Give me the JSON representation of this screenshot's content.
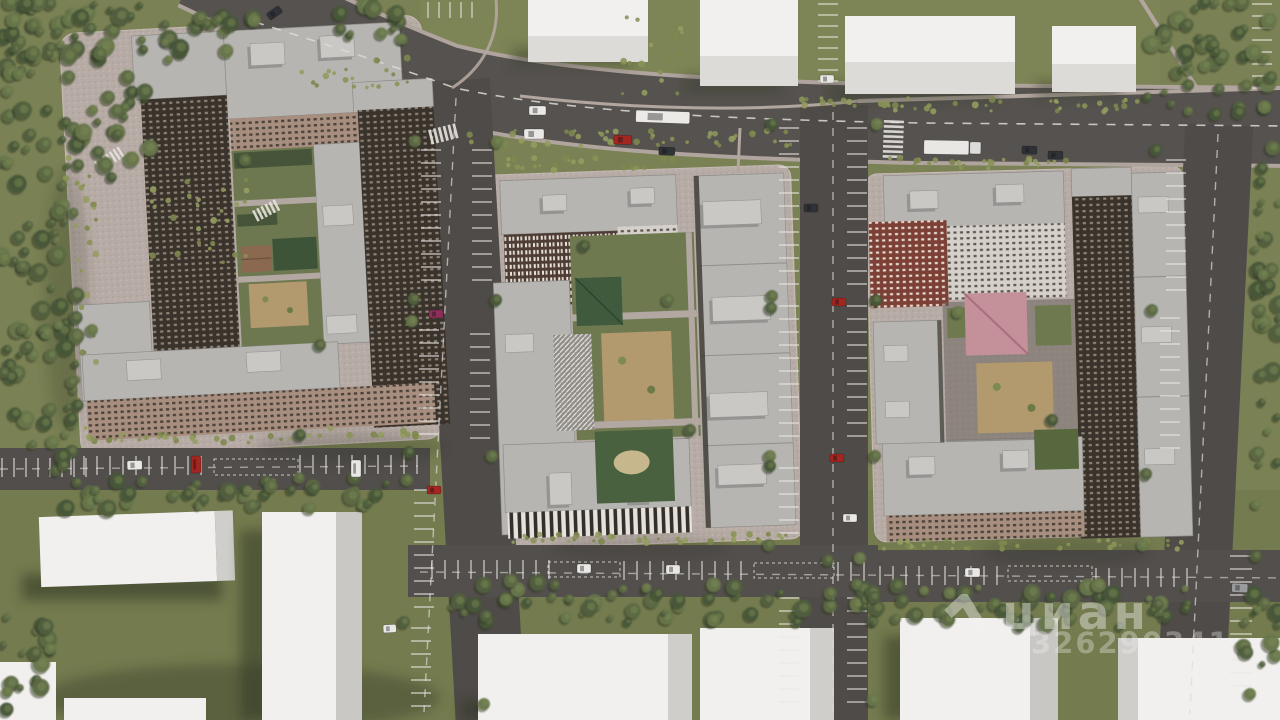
{
  "watermark": {
    "brand": "циан",
    "id_label": "ID 326290341",
    "logo_icon": "cian-chevron-logo",
    "color": "#F4F4F2"
  },
  "palette": {
    "lawn": "#7a8154",
    "lawn_dark": "#747b4f",
    "lawn_light": "#7f8757",
    "road": "#514d4a",
    "road_dark": "#4f4b48",
    "pad": "#b7aba5",
    "pad_rim": "#c6bab4",
    "roof": "#b6b5b2",
    "roof_edge": "#8d8c89",
    "roof_box": "#c9c8c5",
    "facade_dark": "#3a332c",
    "facade_brick": "#a78e7e",
    "facade_red": "#7c4036",
    "facade_light": "#d5d0c9",
    "white_building": "#f1f0ee",
    "white_building_side": "#cfcecb",
    "playground_sand": "#b29a6e",
    "sport_green": "#49613f",
    "marking": "#eae8e4"
  },
  "scene": {
    "description": "aerial 3D render of three residential quarters with courtyards, roads, parking and context buildings",
    "tree_colors": [
      "#5c6a45",
      "#51603f",
      "#68774b",
      "#475638"
    ],
    "bush_colors": [
      "#8a9356",
      "#7d874e",
      "#939c5f"
    ],
    "tree_regions": [
      {
        "x": 0,
        "y": 0,
        "w": 78,
        "h": 475,
        "n": 100
      },
      {
        "x": 0,
        "y": 0,
        "w": 255,
        "h": 60,
        "n": 52
      },
      {
        "x": 62,
        "y": 62,
        "w": 90,
        "h": 120,
        "n": 26
      },
      {
        "x": 330,
        "y": 0,
        "w": 80,
        "h": 40,
        "n": 14
      },
      {
        "x": 1142,
        "y": 0,
        "w": 138,
        "h": 116,
        "n": 46
      },
      {
        "x": 1252,
        "y": 128,
        "w": 28,
        "h": 185,
        "n": 16
      },
      {
        "x": 1256,
        "y": 300,
        "w": 24,
        "h": 205,
        "n": 14
      },
      {
        "x": 55,
        "y": 477,
        "w": 345,
        "h": 32,
        "n": 42
      },
      {
        "x": 424,
        "y": 580,
        "w": 452,
        "h": 42,
        "n": 54
      },
      {
        "x": 868,
        "y": 585,
        "w": 330,
        "h": 44,
        "n": 42
      },
      {
        "x": 0,
        "y": 598,
        "w": 58,
        "h": 122,
        "n": 18
      },
      {
        "x": 1238,
        "y": 582,
        "w": 42,
        "h": 84,
        "n": 12
      }
    ],
    "street_trees": [
      [
        415,
        141
      ],
      [
        414,
        299
      ],
      [
        412,
        321
      ],
      [
        409,
        452
      ],
      [
        407,
        480
      ],
      [
        404,
        622
      ],
      [
        497,
        142
      ],
      [
        496,
        300
      ],
      [
        492,
        456
      ],
      [
        486,
        616
      ],
      [
        484,
        704
      ],
      [
        772,
        124
      ],
      [
        772,
        296
      ],
      [
        771,
        308
      ],
      [
        770,
        456
      ],
      [
        770,
        466
      ],
      [
        769,
        545
      ],
      [
        768,
        600
      ],
      [
        877,
        124
      ],
      [
        876,
        300
      ],
      [
        875,
        456
      ],
      [
        874,
        597
      ],
      [
        873,
        700
      ],
      [
        1156,
        150
      ],
      [
        1152,
        310
      ],
      [
        1146,
        474
      ],
      [
        1143,
        545
      ],
      [
        1262,
        168
      ],
      [
        1260,
        310
      ],
      [
        1256,
        556
      ],
      [
        1250,
        694
      ],
      [
        1205,
        2
      ],
      [
        1230,
        4
      ],
      [
        828,
        560
      ],
      [
        860,
        558
      ],
      [
        584,
        246
      ],
      [
        668,
        300
      ],
      [
        690,
        430
      ],
      [
        958,
        312
      ],
      [
        1052,
        420
      ],
      [
        245,
        160
      ],
      [
        320,
        345
      ],
      [
        92,
        330
      ],
      [
        300,
        435
      ]
    ],
    "bush_strips": [
      {
        "x": 452,
        "y": 130,
        "w": 340,
        "h": 16,
        "n": 46
      },
      {
        "x": 880,
        "y": 98,
        "w": 260,
        "h": 14,
        "n": 34
      },
      {
        "x": 300,
        "y": 58,
        "w": 110,
        "h": 34,
        "n": 20
      },
      {
        "x": 150,
        "y": 178,
        "w": 100,
        "h": 90,
        "n": 26
      },
      {
        "x": 62,
        "y": 150,
        "w": 34,
        "h": 300,
        "n": 30
      },
      {
        "x": 500,
        "y": 534,
        "w": 186,
        "h": 9,
        "n": 24
      },
      {
        "x": 700,
        "y": 534,
        "w": 92,
        "h": 9,
        "n": 12
      },
      {
        "x": 878,
        "y": 540,
        "w": 196,
        "h": 9,
        "n": 24
      },
      {
        "x": 1086,
        "y": 540,
        "w": 96,
        "h": 9,
        "n": 12
      },
      {
        "x": 84,
        "y": 434,
        "w": 240,
        "h": 9,
        "n": 28
      },
      {
        "x": 330,
        "y": 428,
        "w": 96,
        "h": 9,
        "n": 12
      },
      {
        "x": 508,
        "y": 158,
        "w": 170,
        "h": 12,
        "n": 22
      },
      {
        "x": 890,
        "y": 158,
        "w": 200,
        "h": 12,
        "n": 24
      },
      {
        "x": 618,
        "y": 14,
        "w": 70,
        "h": 80,
        "n": 16
      },
      {
        "x": 800,
        "y": 96,
        "w": 60,
        "h": 12,
        "n": 10
      }
    ],
    "parking_rows": [
      {
        "x": 421,
        "y": 150,
        "n": 11,
        "step": 13,
        "len": 20,
        "o": "h"
      },
      {
        "x": 419,
        "y": 330,
        "n": 9,
        "step": 13,
        "len": 20,
        "o": "h"
      },
      {
        "x": 414,
        "y": 490,
        "n": 10,
        "step": 13,
        "len": 20,
        "o": "h"
      },
      {
        "x": 411,
        "y": 628,
        "n": 7,
        "step": 13,
        "len": 20,
        "o": "h"
      },
      {
        "x": 472,
        "y": 150,
        "n": 11,
        "step": 13,
        "len": 20,
        "o": "h"
      },
      {
        "x": 470,
        "y": 334,
        "n": 9,
        "step": 13,
        "len": 20,
        "o": "h"
      },
      {
        "x": 779,
        "y": 128,
        "n": 13,
        "step": 13,
        "len": 20,
        "o": "h"
      },
      {
        "x": 779,
        "y": 306,
        "n": 11,
        "step": 13,
        "len": 20,
        "o": "h"
      },
      {
        "x": 779,
        "y": 468,
        "n": 6,
        "step": 13,
        "len": 20,
        "o": "h"
      },
      {
        "x": 779,
        "y": 598,
        "n": 9,
        "step": 13,
        "len": 20,
        "o": "h"
      },
      {
        "x": 847,
        "y": 128,
        "n": 13,
        "step": 13,
        "len": 20,
        "o": "h"
      },
      {
        "x": 847,
        "y": 306,
        "n": 11,
        "step": 13,
        "len": 20,
        "o": "h"
      },
      {
        "x": 847,
        "y": 598,
        "n": 9,
        "step": 13,
        "len": 20,
        "o": "h"
      },
      {
        "x": 1166,
        "y": 160,
        "n": 11,
        "step": 13,
        "len": 20,
        "o": "h"
      },
      {
        "x": 1160,
        "y": 318,
        "n": 11,
        "step": 13,
        "len": 20,
        "o": "h"
      },
      {
        "x": 1252,
        "y": 4,
        "n": 8,
        "step": 12,
        "len": 20,
        "o": "h"
      },
      {
        "x": 1230,
        "y": 556,
        "n": 11,
        "step": 13,
        "len": 22,
        "o": "h"
      },
      {
        "x": 58,
        "y": 456,
        "n": 12,
        "step": 13,
        "len": 19,
        "o": "v"
      },
      {
        "x": 300,
        "y": 455,
        "n": 10,
        "step": 13,
        "len": 19,
        "o": "v"
      },
      {
        "x": 2,
        "y": 458,
        "n": 8,
        "step": 12,
        "len": 19,
        "o": "v"
      },
      {
        "x": 432,
        "y": 560,
        "n": 10,
        "step": 13,
        "len": 19,
        "o": "v"
      },
      {
        "x": 624,
        "y": 561,
        "n": 10,
        "step": 13,
        "len": 19,
        "o": "v"
      },
      {
        "x": 838,
        "y": 562,
        "n": 3,
        "step": 13,
        "len": 19,
        "o": "v"
      },
      {
        "x": 880,
        "y": 566,
        "n": 10,
        "step": 13,
        "len": 19,
        "o": "v"
      },
      {
        "x": 1096,
        "y": 568,
        "n": 8,
        "step": 13,
        "len": 19,
        "o": "v"
      },
      {
        "x": 818,
        "y": 4,
        "n": 8,
        "step": 11,
        "len": 20,
        "o": "h"
      },
      {
        "x": 428,
        "y": 2,
        "n": 5,
        "step": 11,
        "len": 16,
        "o": "v"
      }
    ],
    "dashed_boxes": [
      {
        "x": 214,
        "y": 459,
        "w": 84,
        "h": 16
      },
      {
        "x": 548,
        "y": 562,
        "w": 72,
        "h": 15
      },
      {
        "x": 754,
        "y": 563,
        "w": 80,
        "h": 15
      },
      {
        "x": 1008,
        "y": 566,
        "w": 84,
        "h": 15
      }
    ],
    "dash_lines": [
      {
        "d": "M 255,22 C 350,52 405,70 455,88 C 570,112 720,119 920,123 L 1290,126",
        "w": 1.6,
        "da": "9 9",
        "op": 0.85
      },
      {
        "d": "M 456,98 L 424,712",
        "w": 1.4,
        "da": "8 8",
        "op": 0.7
      },
      {
        "d": "M 833,112 L 833,714",
        "w": 1.4,
        "da": "8 8",
        "op": 0.7
      },
      {
        "d": "M 1218,134 L 1190,714",
        "w": 1.4,
        "da": "8 8",
        "op": 0.7
      },
      {
        "d": "M 0,469 L 418,466",
        "w": 1.4,
        "da": "8 8",
        "op": 0.6
      },
      {
        "d": "M 420,572 L 1290,578",
        "w": 1.4,
        "da": "8 8",
        "op": 0.6
      }
    ],
    "crosswalks": [
      {
        "x": 884,
        "y": 120,
        "n": 8,
        "bw": 20,
        "bh": 2.6,
        "step": 5,
        "rot": 2,
        "o": "col"
      },
      {
        "x": 428,
        "y": 130,
        "n": 6,
        "bw": 2.8,
        "bh": 15,
        "step": 5,
        "rot": -14,
        "o": "row"
      },
      {
        "x": 252,
        "y": 211,
        "n": 6,
        "bw": 2.6,
        "bh": 12,
        "step": 4.6,
        "rot": -27,
        "o": "row"
      },
      {
        "x": 94,
        "y": 162,
        "n": 7,
        "bw": 2.4,
        "bh": 12,
        "step": 4.4,
        "rot": -33,
        "o": "row"
      }
    ],
    "vehicle_colors": {
      "white": "#e9e8e5",
      "red": "#a32620",
      "magenta": "#8c2f5a",
      "dark": "#2f3236",
      "gray": "#9a9b9d",
      "bus": "#eceae6",
      "truck": "#e8e7e4"
    },
    "vehicles": [
      {
        "x": 529,
        "y": 106,
        "w": 17,
        "h": 9,
        "r": 0,
        "c": "white"
      },
      {
        "x": 524,
        "y": 129,
        "w": 20,
        "h": 10,
        "r": 0,
        "c": "white"
      },
      {
        "x": 636,
        "y": 110,
        "w": 54,
        "h": 12,
        "r": 2,
        "c": "bus"
      },
      {
        "x": 614,
        "y": 135,
        "w": 18,
        "h": 9,
        "r": 2,
        "c": "red"
      },
      {
        "x": 659,
        "y": 147,
        "w": 16,
        "h": 8,
        "r": 2,
        "c": "dark"
      },
      {
        "x": 266,
        "y": 14,
        "w": 15,
        "h": 8,
        "r": -35,
        "c": "dark"
      },
      {
        "x": 924,
        "y": 140,
        "w": 58,
        "h": 14,
        "r": 1,
        "c": "truck"
      },
      {
        "x": 1022,
        "y": 146,
        "w": 15,
        "h": 8,
        "r": 1,
        "c": "dark"
      },
      {
        "x": 1048,
        "y": 151,
        "w": 15,
        "h": 8,
        "r": 1,
        "c": "dark"
      },
      {
        "x": 429,
        "y": 310,
        "w": 14,
        "h": 8,
        "r": 0,
        "c": "magenta"
      },
      {
        "x": 427,
        "y": 486,
        "w": 14,
        "h": 8,
        "r": 0,
        "c": "red"
      },
      {
        "x": 383,
        "y": 625,
        "w": 13,
        "h": 8,
        "r": -3,
        "c": "white"
      },
      {
        "x": 804,
        "y": 204,
        "w": 14,
        "h": 8,
        "r": 0,
        "c": "dark"
      },
      {
        "x": 832,
        "y": 298,
        "w": 14,
        "h": 8,
        "r": 0,
        "c": "red"
      },
      {
        "x": 830,
        "y": 454,
        "w": 14,
        "h": 8,
        "r": 0,
        "c": "red"
      },
      {
        "x": 843,
        "y": 514,
        "w": 14,
        "h": 8,
        "r": 0,
        "c": "white"
      },
      {
        "x": 820,
        "y": 75,
        "w": 14,
        "h": 8,
        "r": 0,
        "c": "white"
      },
      {
        "x": 127,
        "y": 461,
        "w": 15,
        "h": 9,
        "r": -2,
        "c": "white"
      },
      {
        "x": 191,
        "y": 456,
        "w": 10,
        "h": 17,
        "r": 0,
        "c": "red"
      },
      {
        "x": 351,
        "y": 460,
        "w": 10,
        "h": 17,
        "r": 0,
        "c": "white"
      },
      {
        "x": 577,
        "y": 564,
        "w": 14,
        "h": 9,
        "r": 0,
        "c": "white"
      },
      {
        "x": 666,
        "y": 565,
        "w": 14,
        "h": 9,
        "r": 0,
        "c": "white"
      },
      {
        "x": 965,
        "y": 568,
        "w": 15,
        "h": 9,
        "r": 0,
        "c": "white"
      },
      {
        "x": 1232,
        "y": 583,
        "w": 16,
        "h": 9,
        "r": 3,
        "c": "gray"
      }
    ],
    "shadows": [
      {
        "x": 240,
        "y": 698,
        "rx": 200,
        "ry": 34,
        "op": 0.3
      },
      {
        "x": 350,
        "y": 448,
        "rx": 95,
        "ry": 16,
        "op": 0.2
      },
      {
        "x": 1065,
        "y": 552,
        "rx": 85,
        "ry": 15,
        "op": 0.18
      },
      {
        "x": 640,
        "y": 548,
        "rx": 90,
        "ry": 12,
        "op": 0.15
      },
      {
        "x": 66,
        "y": 300,
        "rx": 22,
        "ry": 130,
        "op": 0.18
      }
    ]
  }
}
